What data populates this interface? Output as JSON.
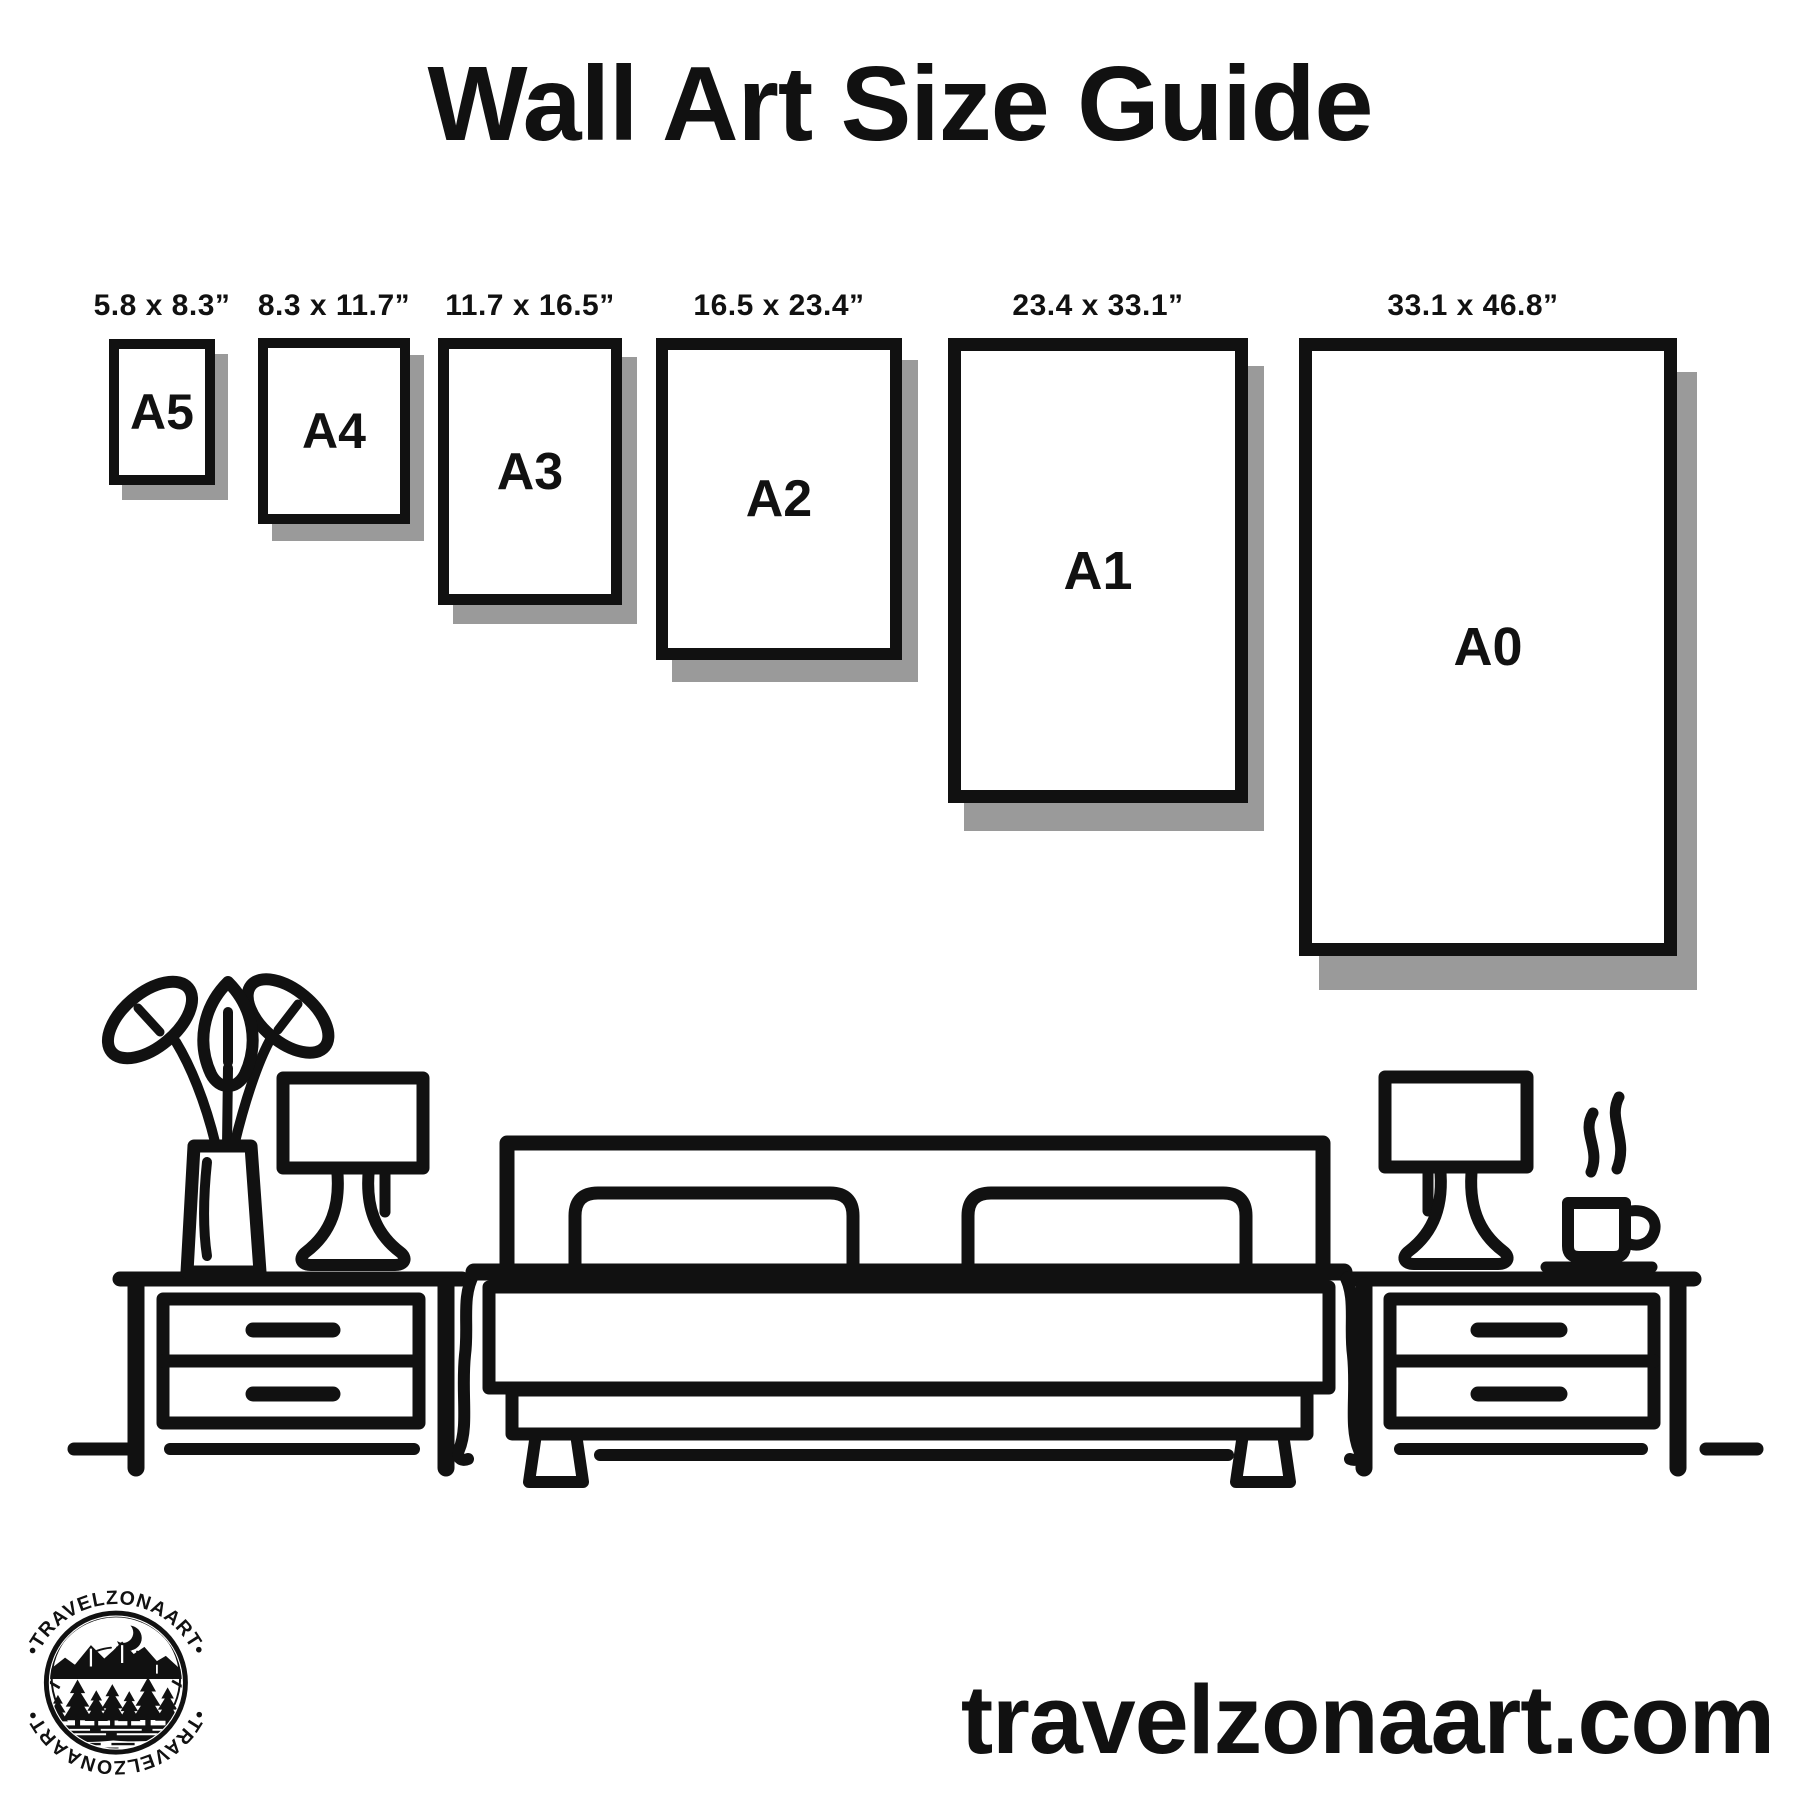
{
  "colors": {
    "background": "#ffffff",
    "ink": "#111111",
    "shadow": "#9a9a9a"
  },
  "header": {
    "title": "Wall Art Size Guide"
  },
  "size_guide": {
    "papers": [
      {
        "name": "A5",
        "size_label": "5.8 x 8.3”"
      },
      {
        "name": "A4",
        "size_label": "8.3 x 11.7”"
      },
      {
        "name": "A3",
        "size_label": "11.7 x 16.5”"
      },
      {
        "name": "A2",
        "size_label": "16.5 x 23.4”"
      },
      {
        "name": "A1",
        "size_label": "23.4 x 33.1”"
      },
      {
        "name": "A0",
        "size_label": "33.1 x 46.8”"
      }
    ]
  },
  "illustration": {
    "icons": [
      "potted-plant-icon",
      "table-lamp-icon",
      "nightstand-icon",
      "double-bed-icon",
      "coffee-mug-steam-icon"
    ]
  },
  "footer": {
    "website": "travelzonaart.com",
    "logo": {
      "arc_text_top": "•TRAVELZONAART•",
      "arc_text_bottom": "•TRAVELZONAART•"
    }
  }
}
